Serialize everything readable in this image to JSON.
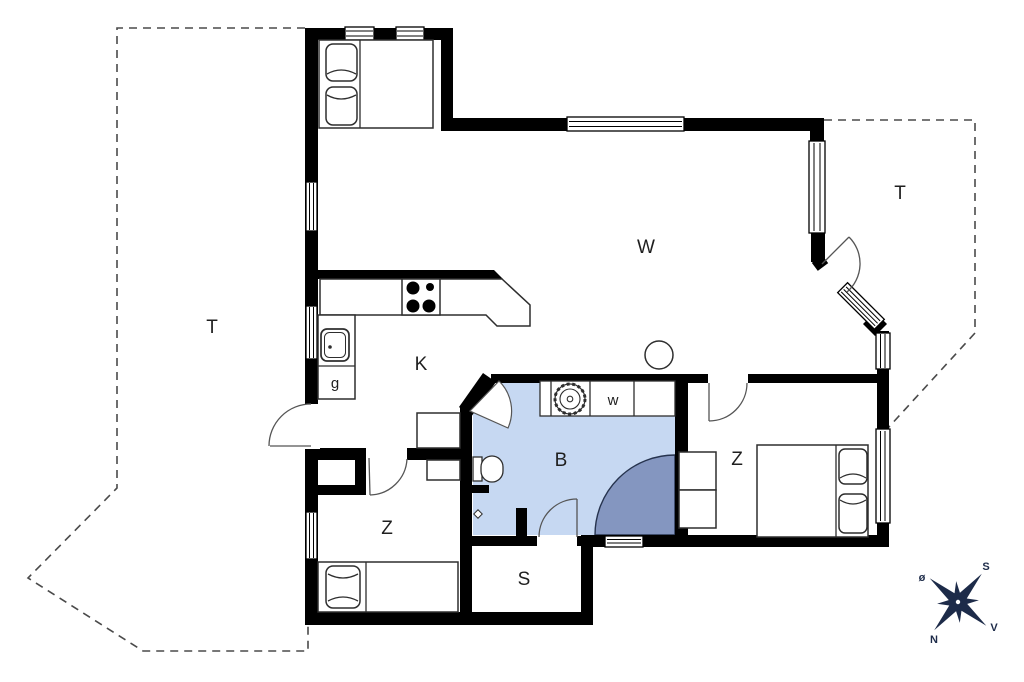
{
  "plan": {
    "rooms": {
      "living": "W",
      "kitchen": "K",
      "bathroom": "B",
      "bedroom_left": "Z",
      "bedroom_right": "Z",
      "shed": "S",
      "wardrobe": "g",
      "washing_machine": "w",
      "terrace_left": "T",
      "terrace_right": "T"
    },
    "compass": {
      "north": "N",
      "south": "S",
      "east": "ø",
      "west": "V"
    },
    "colors": {
      "wall": "#000000",
      "bathroom_floor": "#c6d8f2",
      "shower": "#8496c0",
      "compass": "#1d2b49",
      "dashed_line": "#4a4a4a",
      "label": "#1f1f1f"
    }
  }
}
